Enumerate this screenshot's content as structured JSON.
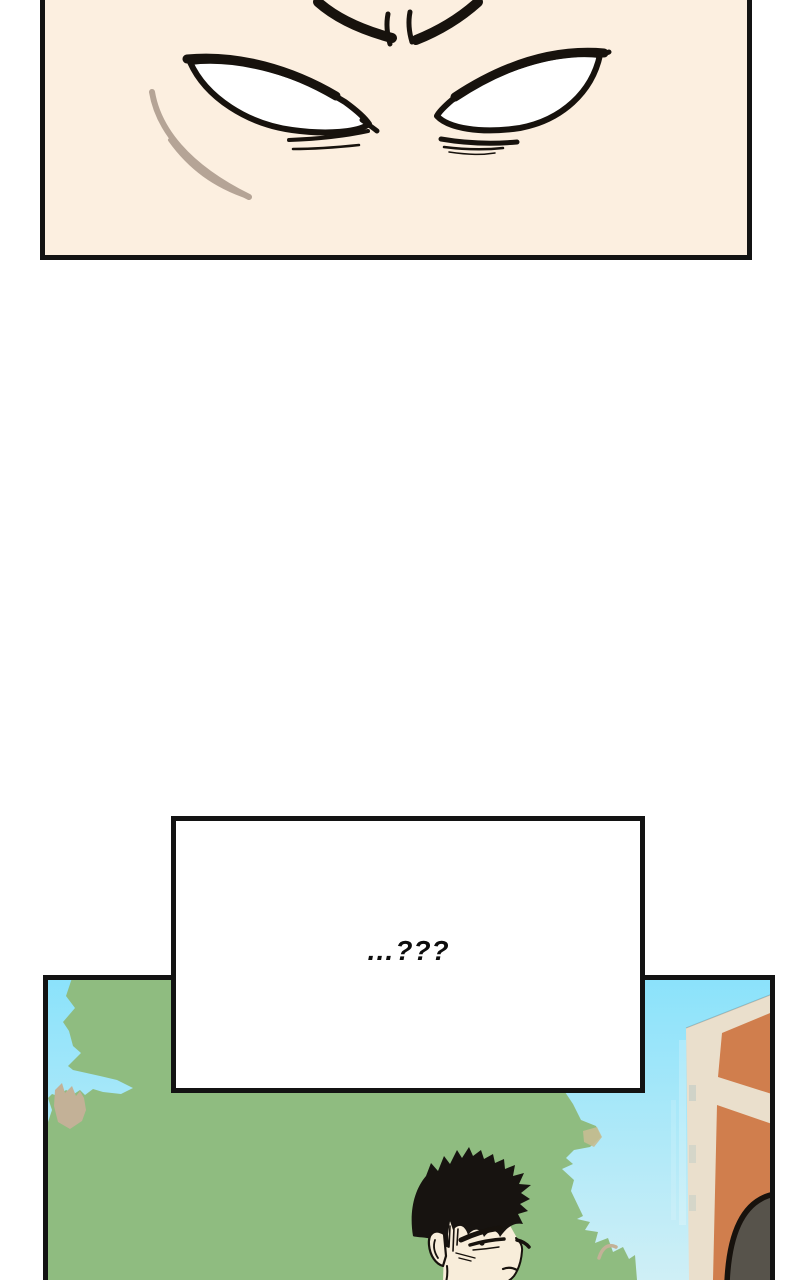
{
  "page": {
    "width": 800,
    "height": 1280,
    "background": "#ffffff"
  },
  "speech_bubble": {
    "text": "…???"
  },
  "colors": {
    "panel_bg": "#fcefe0",
    "ink": "#17120d",
    "border": "#131313",
    "eye_white": "#ffffff",
    "strand_brown": "#b5a496",
    "sky_top": "#8ae2fb",
    "sky_bottom": "#cfeff6",
    "hedge_green": "#8fbc80",
    "branch_tan": "#c3b197",
    "patch_tan": "#c6bc92",
    "building_orange": "#d07e4d",
    "building_cream": "#eadfcc",
    "silhouette_gray": "#57534b",
    "skin": "#f8edda",
    "hair_black": "#171310",
    "bubble_bg": "#ffffff",
    "bubble_text": "#0d0d0d"
  }
}
